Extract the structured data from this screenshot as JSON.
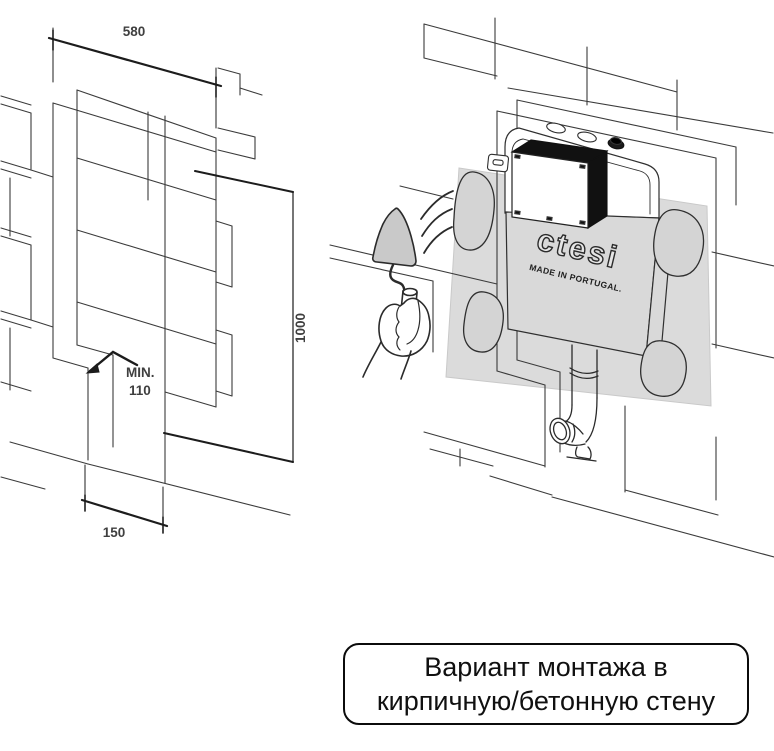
{
  "figure_left": {
    "description": "isometric wall niche dimensions drawing",
    "dim_width": "580",
    "dim_height": "1000",
    "dim_depth_line1": "MIN.",
    "dim_depth_line2": "110",
    "dim_channel": "150"
  },
  "figure_right": {
    "description": "cistern mortared into brick wall illustration",
    "brand": "ctesi",
    "brand_sub": "MADE IN PORTUGAL."
  },
  "caption": {
    "line1": "Вариант монтажа в",
    "line2": "кирпичную/бетонную стену"
  },
  "colors": {
    "line": "#3b3b3b",
    "dim_line": "#1c1c1c",
    "mortar_fill": "#d4d4d4",
    "cistern_fill": "#d9d9d9",
    "shadow_panel": "#dbdbdb",
    "inspection_box": "#111111",
    "background": "#ffffff",
    "caption_border": "#0b0b0b"
  }
}
